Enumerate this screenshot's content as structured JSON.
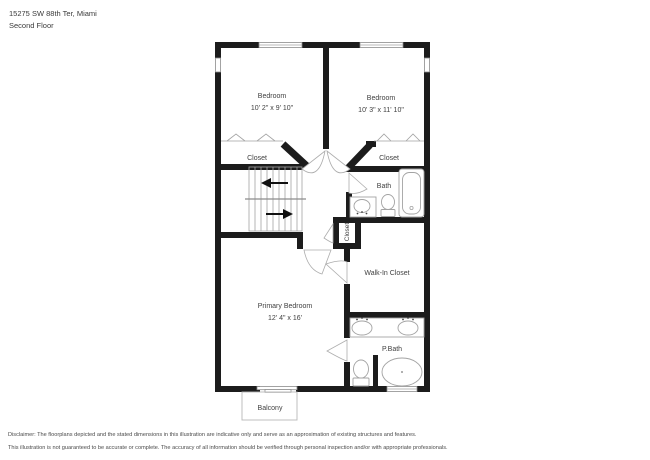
{
  "header": {
    "address": "15275 SW 88th Ter, Miami",
    "floor": "Second Floor"
  },
  "rooms": {
    "bedroom_left": {
      "name": "Bedroom",
      "dims": "10' 2\" x 9' 10\""
    },
    "bedroom_right": {
      "name": "Bedroom",
      "dims": "10' 3\" x 11' 10\""
    },
    "closet_left": {
      "name": "Closet"
    },
    "closet_right": {
      "name": "Closet"
    },
    "bath": {
      "name": "Bath"
    },
    "closet_mid": {
      "name": "Closet"
    },
    "walk_in_closet": {
      "name": "Walk-In Closet"
    },
    "primary_bedroom": {
      "name": "Primary Bedroom",
      "dims": "12' 4\" x 16'"
    },
    "p_bath": {
      "name": "P.Bath"
    },
    "balcony": {
      "name": "Balcony"
    }
  },
  "disclaimer": {
    "line1": "Disclaimer: The floorplans depicted and the stated dimensions in this illustration are indicative only and serve as an approximation of existing structures and features.",
    "line2": "This illustration is not guaranteed to be accurate or complete. The accuracy of all information should be verified through personal inspection and/or with appropriate professionals."
  },
  "colors": {
    "wall": "#1c1c1c",
    "fixture_line": "#a3a3a3",
    "label_text": "#3f3f3f"
  }
}
